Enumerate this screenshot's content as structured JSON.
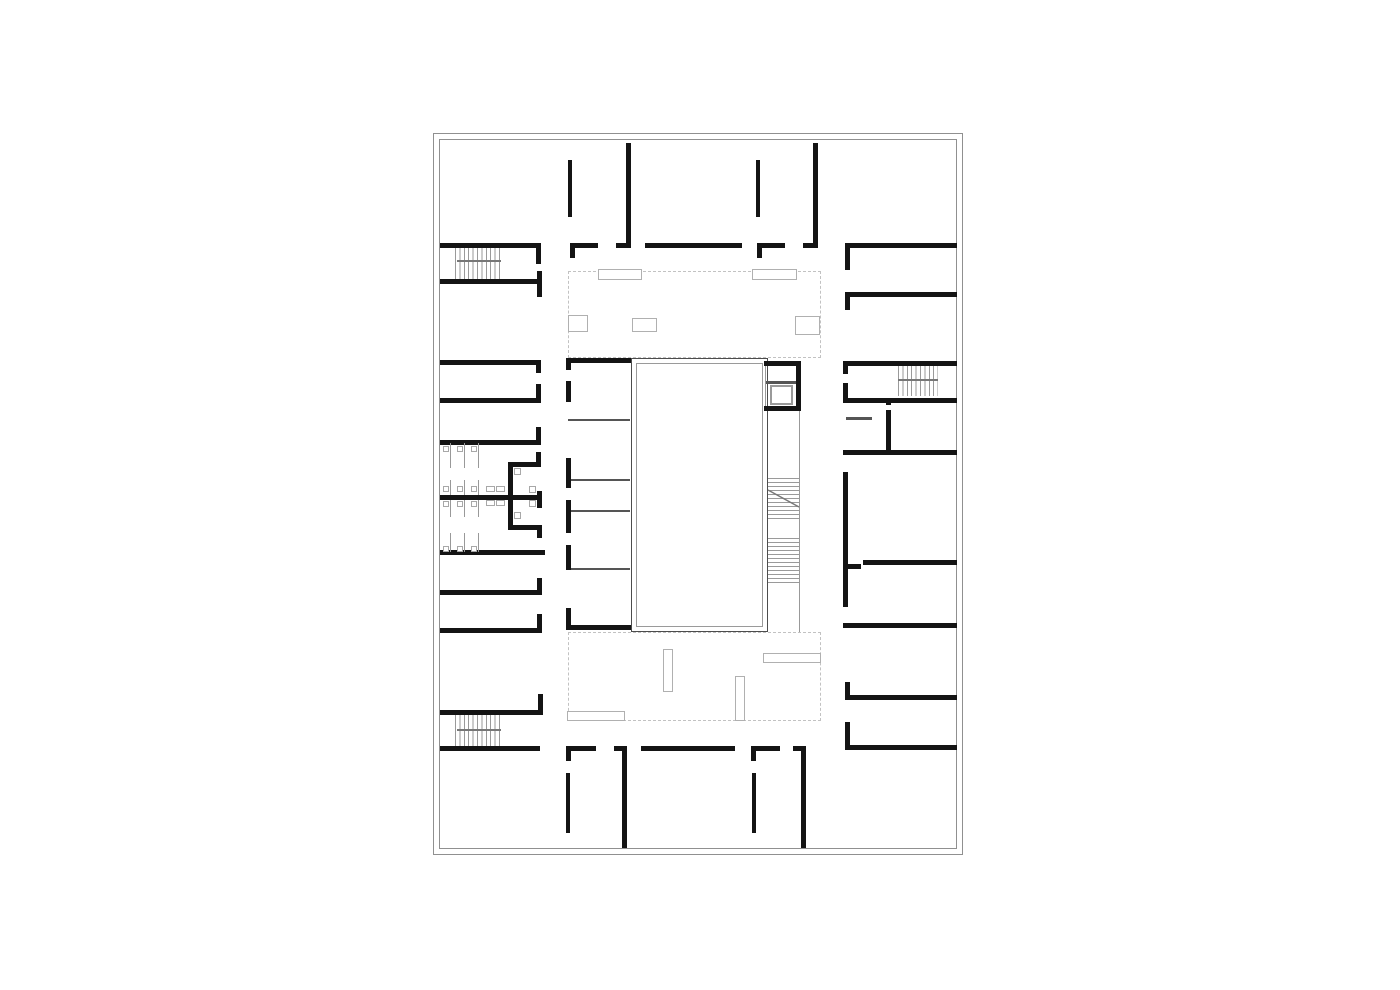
{
  "canvas": {
    "width": 1400,
    "height": 990,
    "background": "#ffffff"
  },
  "plan": {
    "name": "building-floor-plan",
    "colors": {
      "wall": "#141414",
      "partition": "#555555",
      "stair_tread": "#9a9a9a",
      "stair_landing": "#777777",
      "border": "#909090",
      "dashed_outline": "#c2c2c2",
      "furniture": "#b0b0b0",
      "atrium_outer": "#4d4d4d",
      "atrium_inner": "#9a9a9a"
    },
    "border": {
      "outer": [
        433,
        133,
        530,
        722
      ],
      "inner": [
        439,
        139,
        518,
        710
      ]
    },
    "walls_thick": [
      [
        440,
        243,
        100,
        5
      ],
      [
        536,
        243,
        5,
        21
      ],
      [
        440,
        279,
        100,
        5
      ],
      [
        537,
        271,
        5,
        26
      ],
      [
        440,
        360,
        100,
        5
      ],
      [
        536,
        360,
        5,
        13
      ],
      [
        440,
        398,
        100,
        5
      ],
      [
        536,
        384,
        5,
        19
      ],
      [
        440,
        440,
        100,
        5
      ],
      [
        536,
        427,
        5,
        18
      ],
      [
        440,
        495,
        101,
        5
      ],
      [
        537,
        491,
        5,
        17
      ],
      [
        508,
        462,
        5,
        68
      ],
      [
        508,
        462,
        33,
        5
      ],
      [
        536,
        452,
        5,
        15
      ],
      [
        508,
        525,
        33,
        5
      ],
      [
        537,
        525,
        5,
        13
      ],
      [
        440,
        550,
        105,
        5
      ],
      [
        440,
        590,
        100,
        5
      ],
      [
        537,
        578,
        5,
        17
      ],
      [
        440,
        628,
        100,
        5
      ],
      [
        537,
        614,
        5,
        19
      ],
      [
        440,
        710,
        103,
        5
      ],
      [
        538,
        694,
        5,
        21
      ],
      [
        440,
        746,
        100,
        5
      ],
      [
        626,
        143,
        5,
        102
      ],
      [
        813,
        143,
        5,
        102
      ],
      [
        568,
        160,
        4,
        57
      ],
      [
        756,
        160,
        4,
        57
      ],
      [
        570,
        243,
        28,
        5
      ],
      [
        570,
        248,
        5,
        10
      ],
      [
        616,
        243,
        15,
        5
      ],
      [
        645,
        243,
        97,
        5
      ],
      [
        757,
        243,
        28,
        5
      ],
      [
        757,
        248,
        5,
        10
      ],
      [
        803,
        243,
        15,
        5
      ],
      [
        845,
        243,
        112,
        5
      ],
      [
        845,
        248,
        5,
        22
      ],
      [
        845,
        292,
        112,
        5
      ],
      [
        845,
        297,
        5,
        13
      ],
      [
        843,
        361,
        114,
        5
      ],
      [
        843,
        366,
        5,
        8
      ],
      [
        843,
        398,
        114,
        5
      ],
      [
        843,
        383,
        5,
        15
      ],
      [
        886,
        398,
        5,
        7
      ],
      [
        886,
        410,
        5,
        42
      ],
      [
        843,
        450,
        114,
        5
      ],
      [
        843,
        472,
        5,
        135
      ],
      [
        863,
        560,
        94,
        5
      ],
      [
        843,
        564,
        18,
        5
      ],
      [
        843,
        623,
        114,
        5
      ],
      [
        845,
        695,
        112,
        5
      ],
      [
        845,
        682,
        5,
        13
      ],
      [
        845,
        745,
        112,
        5
      ],
      [
        845,
        722,
        5,
        23
      ],
      [
        622,
        746,
        5,
        102
      ],
      [
        801,
        746,
        5,
        102
      ],
      [
        566,
        773,
        4,
        60
      ],
      [
        752,
        773,
        4,
        60
      ],
      [
        566,
        746,
        30,
        5
      ],
      [
        566,
        751,
        5,
        10
      ],
      [
        614,
        746,
        13,
        5
      ],
      [
        641,
        746,
        94,
        5
      ],
      [
        751,
        746,
        29,
        5
      ],
      [
        751,
        751,
        5,
        10
      ],
      [
        793,
        746,
        13,
        5
      ],
      [
        566,
        358,
        65,
        5
      ],
      [
        566,
        625,
        65,
        5
      ],
      [
        566,
        358,
        5,
        12
      ],
      [
        566,
        381,
        5,
        21
      ],
      [
        566,
        458,
        5,
        30
      ],
      [
        566,
        500,
        5,
        33
      ],
      [
        566,
        545,
        5,
        25
      ],
      [
        566,
        608,
        5,
        22
      ],
      [
        764,
        361,
        37,
        5
      ],
      [
        796,
        361,
        5,
        50
      ],
      [
        764,
        406,
        37,
        5
      ]
    ],
    "walls_medium": [
      [
        568,
        419,
        62,
        2
      ],
      [
        568,
        479,
        62,
        2
      ],
      [
        568,
        510,
        62,
        2
      ],
      [
        568,
        568,
        62,
        2
      ],
      [
        846,
        417,
        26,
        3
      ],
      [
        766,
        381,
        32,
        3
      ]
    ],
    "thin_lines": [
      [
        765,
        361,
        1,
        50
      ],
      [
        799,
        411,
        1,
        221
      ]
    ],
    "atrium": {
      "outer": [
        631,
        358,
        137,
        274
      ],
      "inner": [
        636,
        363,
        127,
        264
      ]
    },
    "elevator": {
      "shaft": [
        764,
        361,
        37,
        50
      ],
      "car": [
        770,
        385,
        23,
        20
      ]
    },
    "stairs": [
      {
        "name": "stair-top-left",
        "rect": [
          455,
          248,
          48,
          31
        ],
        "dir": "v",
        "landing": [
          457,
          260,
          44,
          2
        ]
      },
      {
        "name": "stair-bottom-left",
        "rect": [
          455,
          715,
          48,
          31
        ],
        "dir": "v",
        "landing": [
          457,
          729,
          44,
          2
        ]
      },
      {
        "name": "stair-top-right",
        "rect": [
          898,
          366,
          40,
          30
        ],
        "dir": "v",
        "landing": [
          898,
          379,
          40,
          2
        ]
      },
      {
        "name": "stair-central-upper",
        "rect": [
          768,
          475,
          31,
          44
        ],
        "dir": "h"
      },
      {
        "name": "stair-central-lower",
        "rect": [
          768,
          538,
          31,
          45
        ],
        "dir": "h"
      }
    ],
    "stair_diagonal": [
      768,
      490,
      799,
      507
    ],
    "dashed_areas": [
      [
        568,
        271,
        253,
        87
      ],
      [
        568,
        632,
        253,
        89
      ]
    ],
    "light_rects": [
      [
        598,
        269,
        44,
        11
      ],
      [
        752,
        269,
        45,
        11
      ],
      [
        568,
        315,
        20,
        17
      ],
      [
        632,
        318,
        25,
        14
      ],
      [
        795,
        316,
        25,
        19
      ],
      [
        663,
        649,
        10,
        43
      ],
      [
        735,
        676,
        10,
        45
      ],
      [
        763,
        653,
        58,
        10
      ],
      [
        567,
        711,
        58,
        10
      ]
    ],
    "desk_lines": [
      [
        450,
        443,
        1,
        25
      ],
      [
        464,
        443,
        1,
        25
      ],
      [
        478,
        443,
        1,
        25
      ],
      [
        450,
        480,
        1,
        15
      ],
      [
        464,
        480,
        1,
        15
      ],
      [
        478,
        480,
        1,
        15
      ],
      [
        450,
        500,
        1,
        17
      ],
      [
        464,
        500,
        1,
        17
      ],
      [
        478,
        500,
        1,
        17
      ],
      [
        450,
        533,
        1,
        19
      ],
      [
        464,
        533,
        1,
        19
      ],
      [
        478,
        533,
        1,
        19
      ]
    ],
    "desk_squares": [
      [
        443,
        446,
        6,
        6
      ],
      [
        457,
        446,
        6,
        6
      ],
      [
        471,
        446,
        6,
        6
      ],
      [
        443,
        486,
        6,
        6
      ],
      [
        457,
        486,
        6,
        6
      ],
      [
        471,
        486,
        6,
        6
      ],
      [
        443,
        501,
        6,
        6
      ],
      [
        457,
        501,
        6,
        6
      ],
      [
        471,
        501,
        6,
        6
      ],
      [
        443,
        546,
        6,
        6
      ],
      [
        457,
        546,
        6,
        6
      ],
      [
        471,
        546,
        6,
        6
      ],
      [
        486,
        486,
        9,
        6
      ],
      [
        496,
        486,
        9,
        6
      ],
      [
        486,
        500,
        9,
        6
      ],
      [
        496,
        500,
        9,
        6
      ],
      [
        514,
        468,
        7,
        7
      ],
      [
        529,
        486,
        7,
        7
      ],
      [
        529,
        500,
        7,
        7
      ],
      [
        514,
        512,
        7,
        7
      ]
    ]
  }
}
